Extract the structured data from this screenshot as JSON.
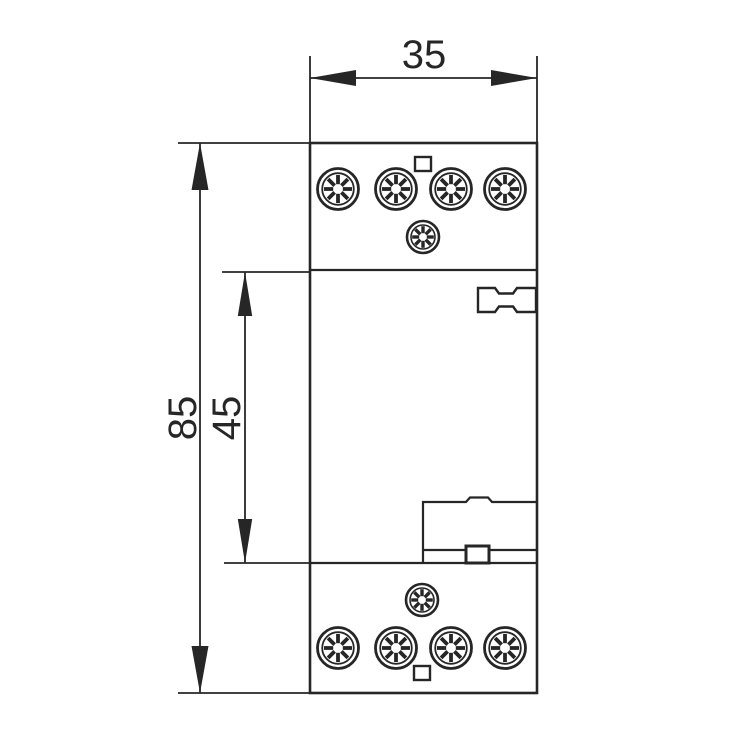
{
  "diagram": {
    "dimension_labels": {
      "width": "35",
      "overall_height": "85",
      "body_height": "45"
    },
    "colors": {
      "line": "#262626",
      "background": "#ffffff"
    }
  }
}
